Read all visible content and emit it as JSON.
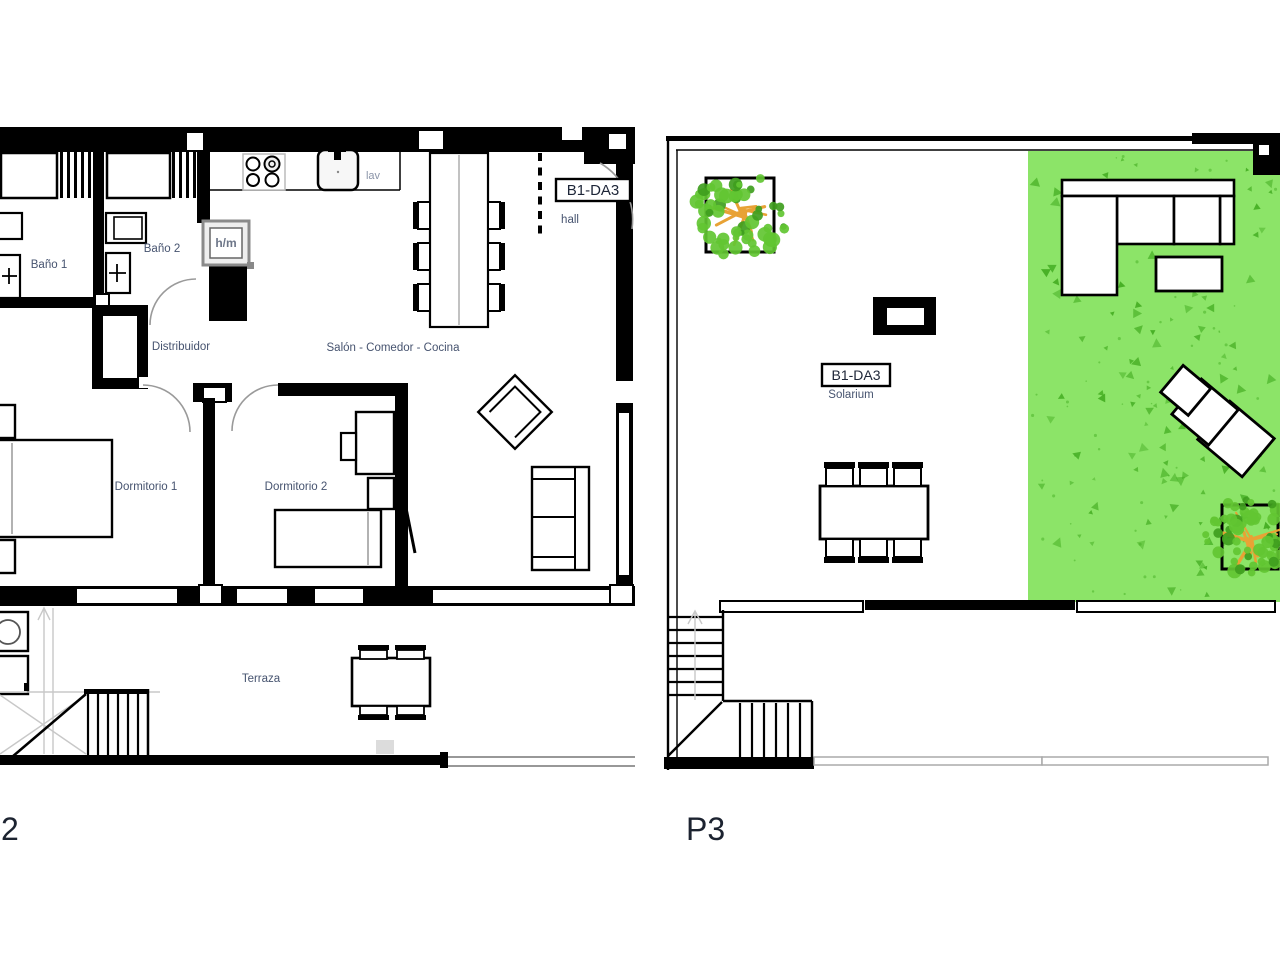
{
  "colors": {
    "wall": "#000000",
    "room_label": "#46536f",
    "small_label": "#8a94a8",
    "hm_label": "#6d7688",
    "tag_text": "#1d2537",
    "plan_id": "#1c2330",
    "grass": "#8ce468",
    "grass_speck": "#44ad22",
    "tree_leaf": "#62c532",
    "tree_leaf_dark": "#3f9e1e",
    "tree_branch": "#e8a235",
    "gray_line": "#c8c8c8"
  },
  "plan_p2": {
    "id_label": "2",
    "unit_box": "B1-DA3",
    "rooms": {
      "bano1": "Baño 1",
      "bano2": "Baño 2",
      "distribuidor": "Distribuidor",
      "salon": "Salón - Comedor - Cocina",
      "hall": "hall",
      "dormitorio1": "Dormitorio 1",
      "dormitorio2": "Dormitorio 2",
      "terraza": "Terraza"
    },
    "fixtures": {
      "lav": "lav",
      "hm": "h/m"
    }
  },
  "plan_p3": {
    "id_label": "P3",
    "unit_box": "B1-DA3",
    "rooms": {
      "solarium": "Solarium"
    }
  }
}
